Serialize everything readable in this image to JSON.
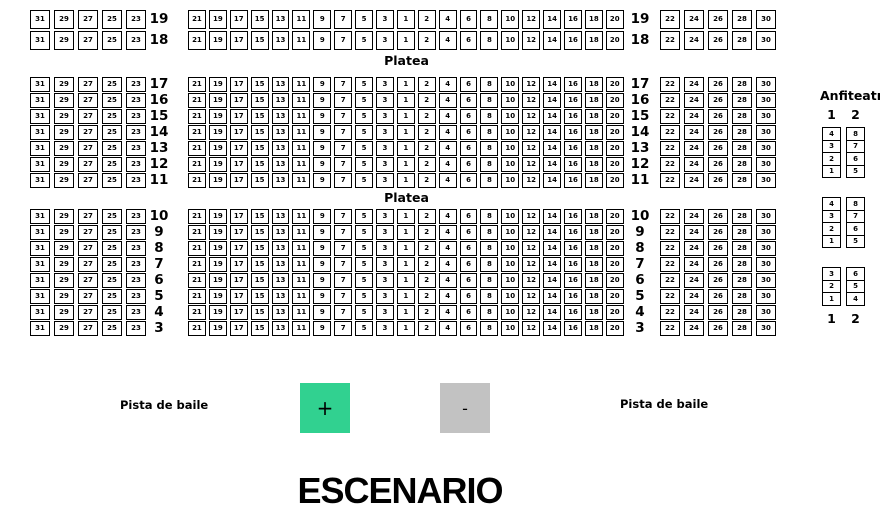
{
  "platea": {
    "label": "Platea",
    "row_groups": [
      [
        19,
        18
      ],
      [
        17,
        16,
        15,
        14,
        13,
        12,
        11
      ],
      [
        10,
        9,
        8,
        7,
        6,
        5,
        4,
        3
      ]
    ],
    "left_block_seats": [
      31,
      29,
      27,
      25,
      23
    ],
    "middle_block_seats": [
      21,
      19,
      17,
      15,
      13,
      11,
      9,
      7,
      5,
      3,
      1,
      2,
      4,
      6,
      8,
      10,
      12,
      14,
      16,
      18,
      20
    ],
    "right_block_seats": [
      22,
      24,
      26,
      28,
      30
    ]
  },
  "anfiteatro": {
    "title": "Anfiteatro",
    "column_labels": [
      "1",
      "2"
    ],
    "groups": [
      {
        "column1_top_to_bottom": [
          4,
          3,
          2,
          1
        ],
        "column2_top_to_bottom": [
          8,
          7,
          6,
          5
        ]
      },
      {
        "column1_top_to_bottom": [
          4,
          3,
          2,
          1
        ],
        "column2_top_to_bottom": [
          8,
          7,
          6,
          5
        ]
      },
      {
        "column1_top_to_bottom": [
          3,
          2,
          1
        ],
        "column2_top_to_bottom": [
          6,
          5,
          4
        ]
      }
    ]
  },
  "dance_floor": {
    "left_label": "Pista de baile",
    "right_label": "Pista de baile"
  },
  "stage_label": "ESCENARIO",
  "controls": {
    "zoom_in_label": "+",
    "zoom_out_label": "-",
    "zoom_in_color": "#31d190",
    "zoom_out_color": "#c2c2c2"
  },
  "colors": {
    "seat_border": "#000000",
    "text": "#000000",
    "background": "#ffffff"
  }
}
